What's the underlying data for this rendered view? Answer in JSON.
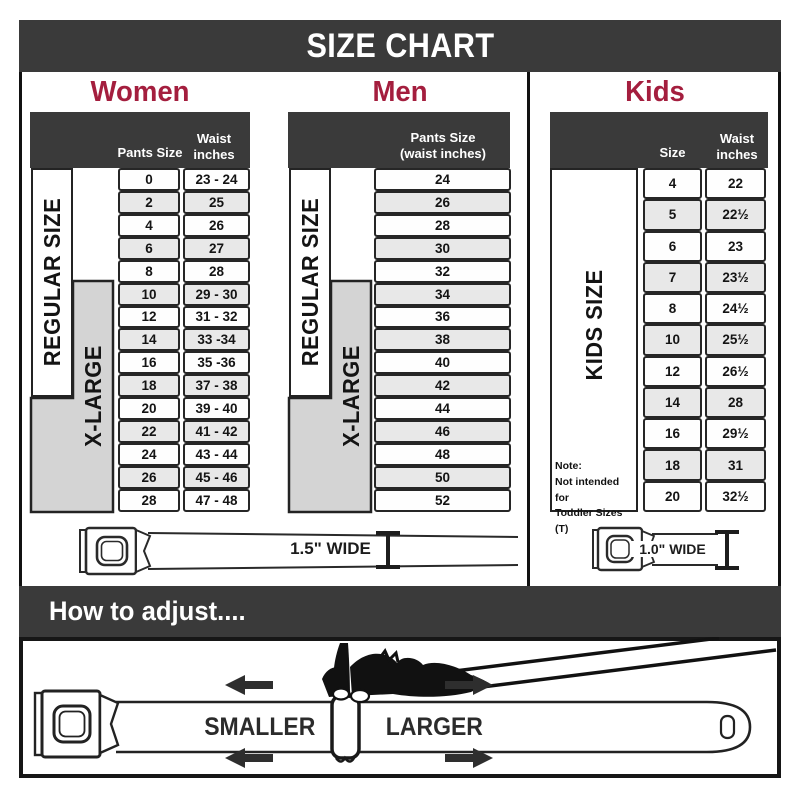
{
  "title": "SIZE CHART",
  "colors": {
    "header_dark": "#3a3a3a",
    "accent_crimson": "#a41e3e",
    "cell_border": "#262626",
    "alt_row": "#e8e8e8",
    "xlarge_gray": "#d4d4d4"
  },
  "sections": {
    "women": {
      "title": "Women",
      "col_headers": [
        "Pants Size",
        "Waist inches"
      ],
      "labels": {
        "regular": "REGULAR SIZE",
        "xlarge": "X-LARGE"
      },
      "rows": [
        [
          "0",
          "23 - 24"
        ],
        [
          "2",
          "25"
        ],
        [
          "4",
          "26"
        ],
        [
          "6",
          "27"
        ],
        [
          "8",
          "28"
        ],
        [
          "10",
          "29 - 30"
        ],
        [
          "12",
          "31 - 32"
        ],
        [
          "14",
          "33 -34"
        ],
        [
          "16",
          "35 -36"
        ],
        [
          "18",
          "37 - 38"
        ],
        [
          "20",
          "39 - 40"
        ],
        [
          "22",
          "41 - 42"
        ],
        [
          "24",
          "43 - 44"
        ],
        [
          "26",
          "45 - 46"
        ],
        [
          "28",
          "47 - 48"
        ]
      ]
    },
    "men": {
      "title": "Men",
      "col_header": [
        "Pants Size",
        "(waist inches)"
      ],
      "labels": {
        "regular": "REGULAR SIZE",
        "xlarge": "X-LARGE"
      },
      "rows": [
        "24",
        "26",
        "28",
        "30",
        "32",
        "34",
        "36",
        "38",
        "40",
        "42",
        "44",
        "46",
        "48",
        "50",
        "52"
      ]
    },
    "kids": {
      "title": "Kids",
      "col_headers": [
        "Size",
        "Waist inches"
      ],
      "label": "KIDS SIZE",
      "note": [
        "Note:",
        "Not intended for",
        "Toddler Sizes (T)"
      ],
      "rows": [
        [
          "4",
          "22"
        ],
        [
          "5",
          "22½"
        ],
        [
          "6",
          "23"
        ],
        [
          "7",
          "23½"
        ],
        [
          "8",
          "24½"
        ],
        [
          "10",
          "25½"
        ],
        [
          "12",
          "26½"
        ],
        [
          "14",
          "28"
        ],
        [
          "16",
          "29½"
        ],
        [
          "18",
          "31"
        ],
        [
          "20",
          "32½"
        ]
      ]
    }
  },
  "belts": {
    "adult_width_label": "1.5\" WIDE",
    "kids_width_label": "1.0\" WIDE"
  },
  "adjust": {
    "title": "How to adjust....",
    "smaller": "SMALLER",
    "larger": "LARGER"
  }
}
